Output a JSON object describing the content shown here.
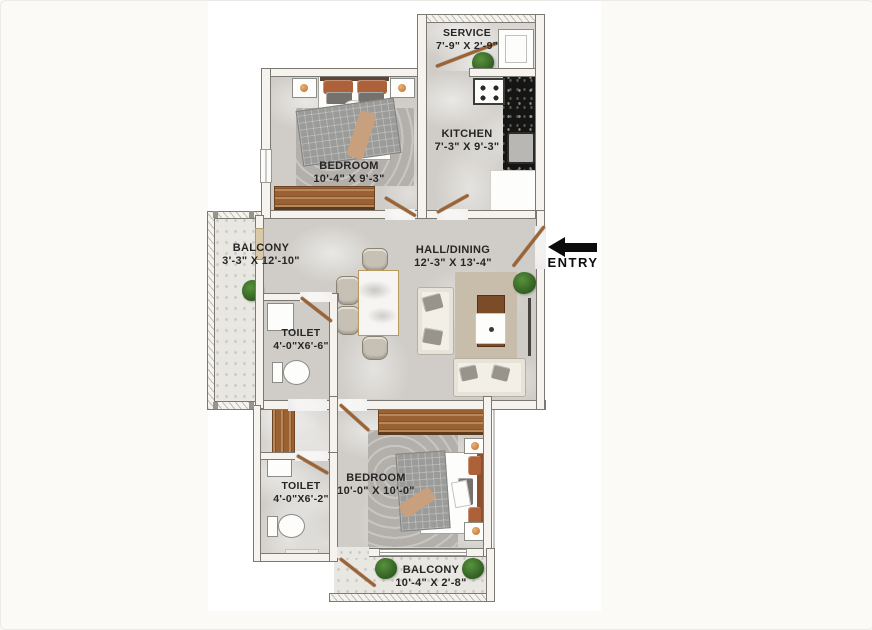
{
  "floor_plan": {
    "rooms": {
      "service": {
        "name": "SERVICE",
        "dims": "7'-9\" X 2'-9\""
      },
      "kitchen": {
        "name": "KITCHEN",
        "dims": "7'-3\" X 9'-3\""
      },
      "bedroom1": {
        "name": "BEDROOM",
        "dims": "10'-4\" X 9'-3\""
      },
      "balcony1": {
        "name": "BALCONY",
        "dims": "3'-3\" X 12'-10\""
      },
      "hall": {
        "name": "HALL/DINING",
        "dims": "12'-3\" X 13'-4\""
      },
      "toilet1": {
        "name": "TOILET",
        "dims": "4'-0\"X6'-6\""
      },
      "toilet2": {
        "name": "TOILET",
        "dims": "4'-0\"X6'-2\""
      },
      "bedroom2": {
        "name": "BEDROOM",
        "dims": "10'-0\" X 10'-0\""
      },
      "balcony2": {
        "name": "BALCONY",
        "dims": "10'-4\" X 2'-8\""
      }
    },
    "entry": {
      "label": "ENTRY"
    },
    "colors": {
      "floor_marble": "#d0cdc8",
      "balcony_marble": "#e9e7e2",
      "wall": "#f6f3ee",
      "wall_outline": "#7b7974",
      "wood_door": "#9a6132",
      "kitchen_counter": "#151513",
      "pillow_accent": "#ad6138",
      "plant_green": "#3c6b2d",
      "rug_beige": "#c8bcab",
      "rug_gray": "#b3b0ac",
      "entry_arrow": "#0c0c0c",
      "label_text": "#262626"
    }
  }
}
